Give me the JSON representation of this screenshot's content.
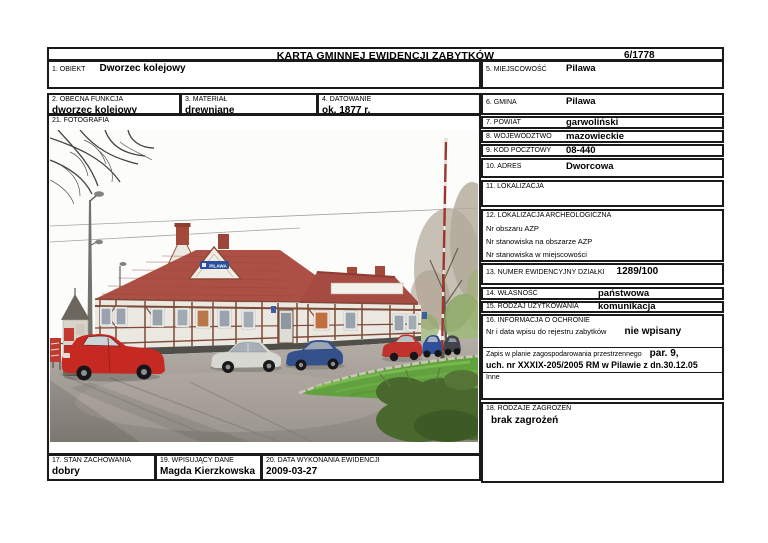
{
  "header": {
    "title": "KARTA GMINNEJ EWIDENCJI ZABYTKÓW",
    "number": "6/1778"
  },
  "fields": {
    "obiekt": {
      "label": "1. OBIEKT",
      "value": "Dworzec kolejowy"
    },
    "obecna_funkcja": {
      "label": "2. OBECNA FUNKCJA",
      "value": "dworzec kolejowy"
    },
    "material": {
      "label": "3. MATERIAŁ",
      "value": "drewniane"
    },
    "datowanie": {
      "label": "4. DATOWANIE",
      "value": "ok. 1877 r."
    },
    "miejscowosc": {
      "label": "5. MIEJSCOWOŚĆ",
      "value": "Pilawa"
    },
    "gmina": {
      "label": "6. GMINA",
      "value": "Pilawa"
    },
    "powiat": {
      "label": "7. POWIAT",
      "value": "garwoliński"
    },
    "wojewodztwo": {
      "label": "8. WOJEWÓDZTWO",
      "value": "mazowieckie"
    },
    "kod_pocztowy": {
      "label": "9. KOD POCZTOWY",
      "value": "08-440"
    },
    "adres": {
      "label": "10. ADRES",
      "value": "Dworcowa"
    },
    "lokalizacja": {
      "label": "11. LOKALIZACJA",
      "value": ""
    },
    "lok_archeologiczna": {
      "label": "12. LOKALIZACJA ARCHEOLOGICZNA",
      "lines": [
        "Nr obszaru AZP",
        "Nr stanowiska na obszarze AZP",
        "Nr stanowiska w miejscowości"
      ]
    },
    "numer_dzialki": {
      "label": "13. NUMER EWIDENCYJNY DZIAŁKI",
      "value": "1289/100"
    },
    "wlasnosc": {
      "label": "14. WŁASNOŚĆ",
      "value": "państwowa"
    },
    "rodzaj_uzytkowania": {
      "label": "15. RODZAJ UŻYTKOWANIA",
      "value": "komunikacja"
    },
    "ochrona": {
      "label": "16. INFORMACJA O OCHRONIE",
      "rejestr_label": "Nr i data wpisu do rejestru zabytków",
      "rejestr_value": "nie wpisany",
      "plan_label": "Zapis w planie zagospodarowania przestrzennego",
      "plan_value_1": "par. 9,",
      "plan_value_2": "uch. nr XXXIX-205/2005 RM w Pilawie z dn.30.12.05",
      "inne_label": "Inne"
    },
    "stan_zachowania": {
      "label": "17. STAN ZACHOWANIA",
      "value": "dobry"
    },
    "rodzaje_zagrozen": {
      "label": "18. RODZAJE ZAGROŻEŃ",
      "value": "brak zagrożeń"
    },
    "wpisujacy": {
      "label": "19. WPISUJĄCY DANE",
      "value": "Magda Kierzkowska"
    },
    "data_wykonania": {
      "label": "20. DATA WYKONANIA EWIDENCJI",
      "value": "2009-03-27"
    },
    "fotografia": {
      "label": "21. FOTOGRAFIA"
    }
  },
  "photo": {
    "sign": "PILAWA"
  },
  "colors": {
    "roof": "#ac5046",
    "sign_blue": "#2b4f9e",
    "grass": "#61a23f",
    "border": "#1a1a1a"
  }
}
